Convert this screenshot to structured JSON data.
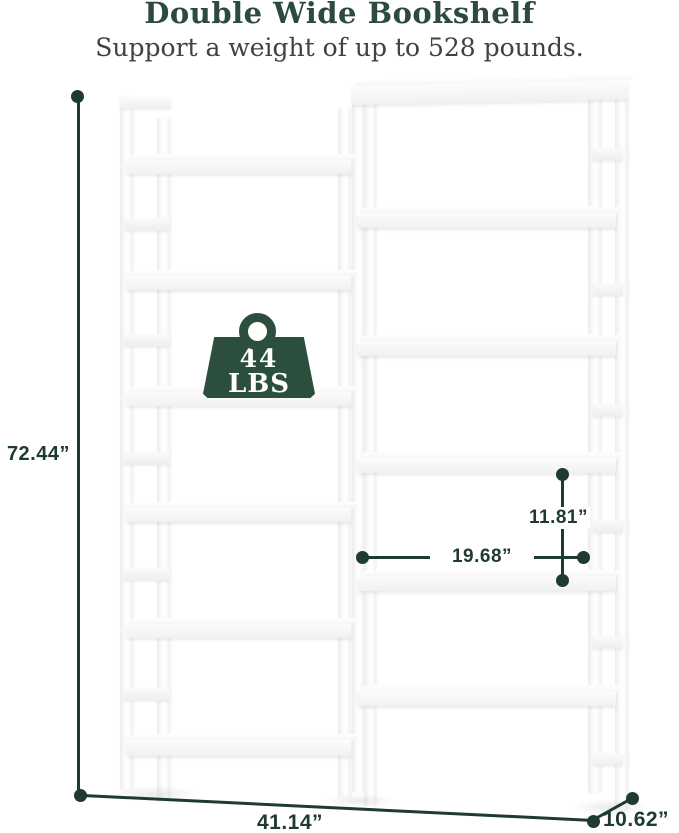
{
  "header": {
    "title": "Double Wide Bookshelf",
    "subtitle": "Support a weight of up to 528 pounds."
  },
  "weight_badge": {
    "value": "44",
    "unit": "LBS"
  },
  "dimensions": {
    "total_height": "72.44”",
    "total_width": "41.14”",
    "depth": "10.62”",
    "shelf_spacing": "11.81”",
    "shelf_width": "19.68”"
  },
  "colors": {
    "title_green": "#2c4b3d",
    "subtitle_gray": "#3c443f",
    "dimension_green": "#1f3a30",
    "badge_green": "#2b4e3d",
    "background": "#ffffff"
  }
}
